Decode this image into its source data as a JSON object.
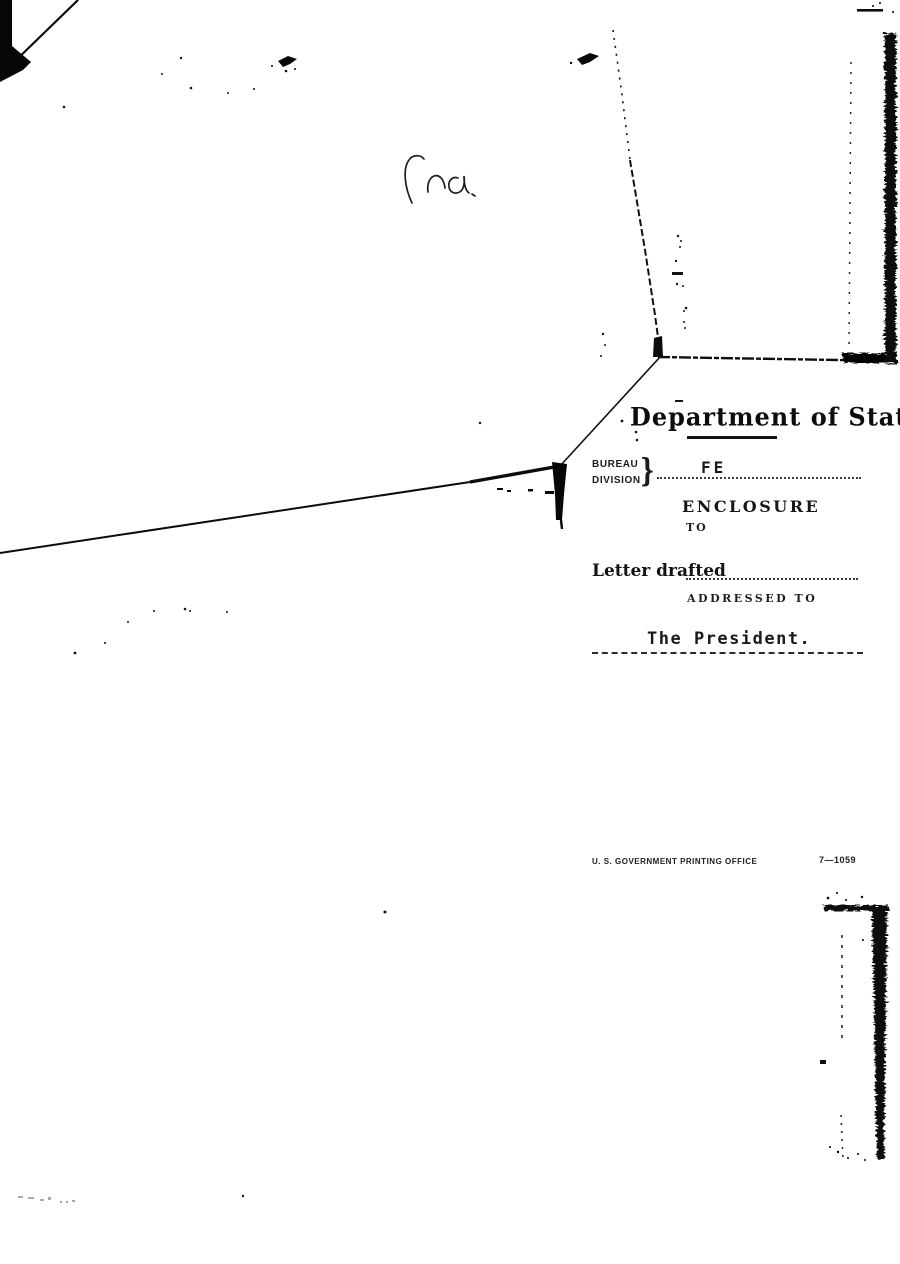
{
  "form": {
    "department_title": "Department of State",
    "bureau_label": "BUREAU",
    "division_label": "DIVISION",
    "brace": "}",
    "bureau_value": "FE",
    "enclosure_label": "ENCLOSURE",
    "enclosure_to_label": "TO",
    "letter_drafted_label": "Letter drafted",
    "addressed_to_label": "ADDRESSED TO",
    "addressed_to_value": "The President.",
    "printer_imprint": "U. S. GOVERNMENT PRINTING OFFICE",
    "form_number": "7—1059"
  },
  "artifacts": {
    "handwritten_mark": "illegible-pencil-scribble",
    "check_marks": 2
  },
  "colors": {
    "ink": "#141414",
    "paper": "#ffffff"
  }
}
